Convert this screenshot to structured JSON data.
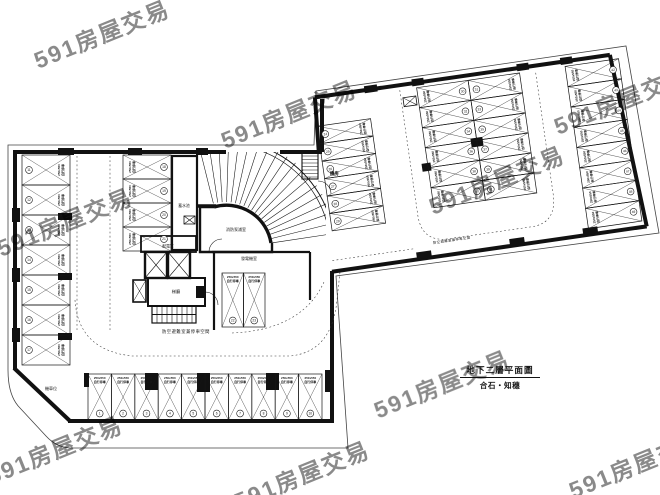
{
  "title_block": {
    "drawing_title": "地下二層平面圖",
    "project_name": "合石・知穗"
  },
  "watermark": {
    "text": "591房屋交易"
  },
  "room_labels": {
    "water_tank": "蓄水池",
    "power_room": "配電室",
    "elevator_lobby": "梯廳",
    "fire_pump_room": "消防泵浦室",
    "generator_room": "發電機室",
    "shelter_parking": "防空避難室兼停車空間",
    "machine_room": "機房",
    "motorcycle": "機車位"
  },
  "stall_label": {
    "size": "250x550",
    "type": "自行停車"
  },
  "parking_groups": {
    "bottom_row": {
      "numbers": [
        1,
        2,
        3,
        4,
        5,
        6,
        7,
        8,
        9,
        10
      ]
    },
    "left_column": {
      "numbers": [
        11,
        12,
        13,
        14,
        15,
        16,
        17
      ]
    },
    "mid_column": {
      "numbers": [
        18,
        19,
        20,
        21
      ]
    },
    "core_pair": {
      "numbers": [
        22,
        23
      ]
    },
    "wing_west": {
      "numbers": [
        24,
        25,
        26,
        27,
        28,
        29
      ]
    },
    "wing_mid_left": {
      "numbers": [
        30,
        32,
        34,
        36,
        38,
        40
      ]
    },
    "wing_mid_right": {
      "numbers": [
        31,
        33,
        35,
        37,
        39,
        41
      ]
    },
    "wing_east": {
      "numbers": [
        42,
        43,
        44,
        45,
        46,
        47,
        48,
        49
      ]
    }
  },
  "colors": {
    "line": "#161616",
    "watermark": "#b3b3b3",
    "paper": "#ffffff"
  }
}
